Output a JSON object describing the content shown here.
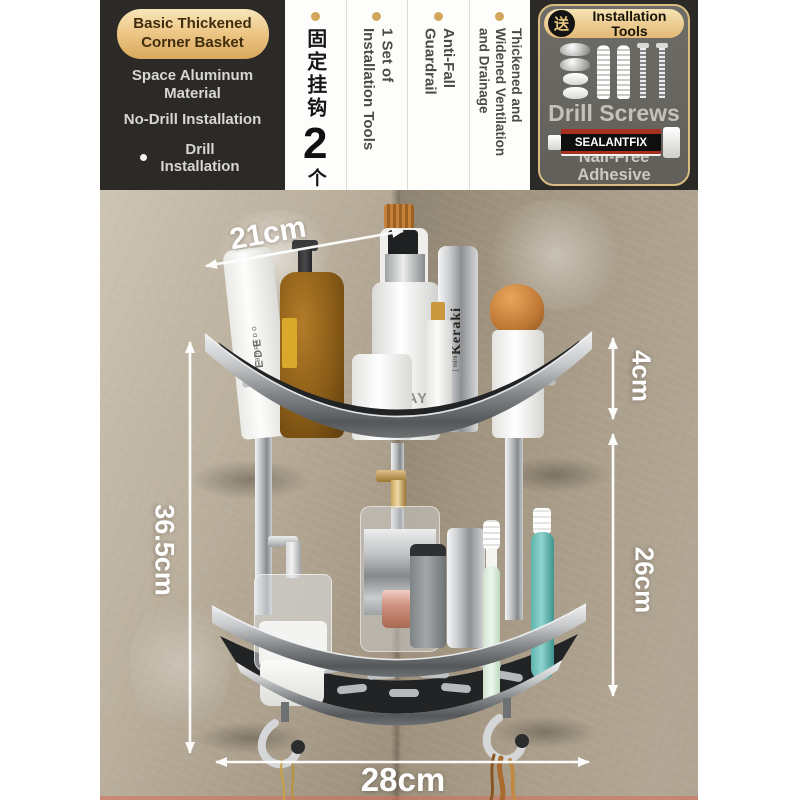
{
  "header": {
    "left_panel": {
      "badge": "Basic Thickened Corner Basket",
      "feature1": "Space Aluminum Material",
      "feature2": "No-Drill Installation",
      "bullet": "•",
      "feature3": "Drill Installation"
    },
    "middle_panel": {
      "hooks_label_cn": "固定挂钩",
      "hooks_count": "2",
      "hooks_unit": "个",
      "vcols": [
        "1 Set of\nInstallation Tools",
        "Anti-Fall\nGuardrail",
        "Thickened and\nWidened Ventilation\nand Drainage"
      ]
    },
    "right_panel": {
      "gift_char": "送",
      "title": "Installation Tools",
      "screws_label": "Drill Screws",
      "tube_label": "SEALANTFIX",
      "adhesive_label": "Nail-Free Adhesive"
    }
  },
  "annotations": {
    "top_width": "21cm",
    "total_height": "36.5cm",
    "guardrail_height": "4cm",
    "tier_gap": "26cm",
    "bottom_width": "28cm"
  },
  "products": {
    "suede_brand": "BYREDO",
    "suede_name": "SUEDE",
    "lierac": "LIERAC",
    "olay": "OLAY",
    "keraki": "Keraki",
    "keraki_mini": "[ mini ]",
    "byredo_small": "BYREDO"
  },
  "colors": {
    "accent_gold": "#d9a85c",
    "panel_dark": "#2b2a27",
    "wall_beige": "#b3a793",
    "metal_gray": "#9fa2a4",
    "annotation_white": "#ffffff"
  }
}
